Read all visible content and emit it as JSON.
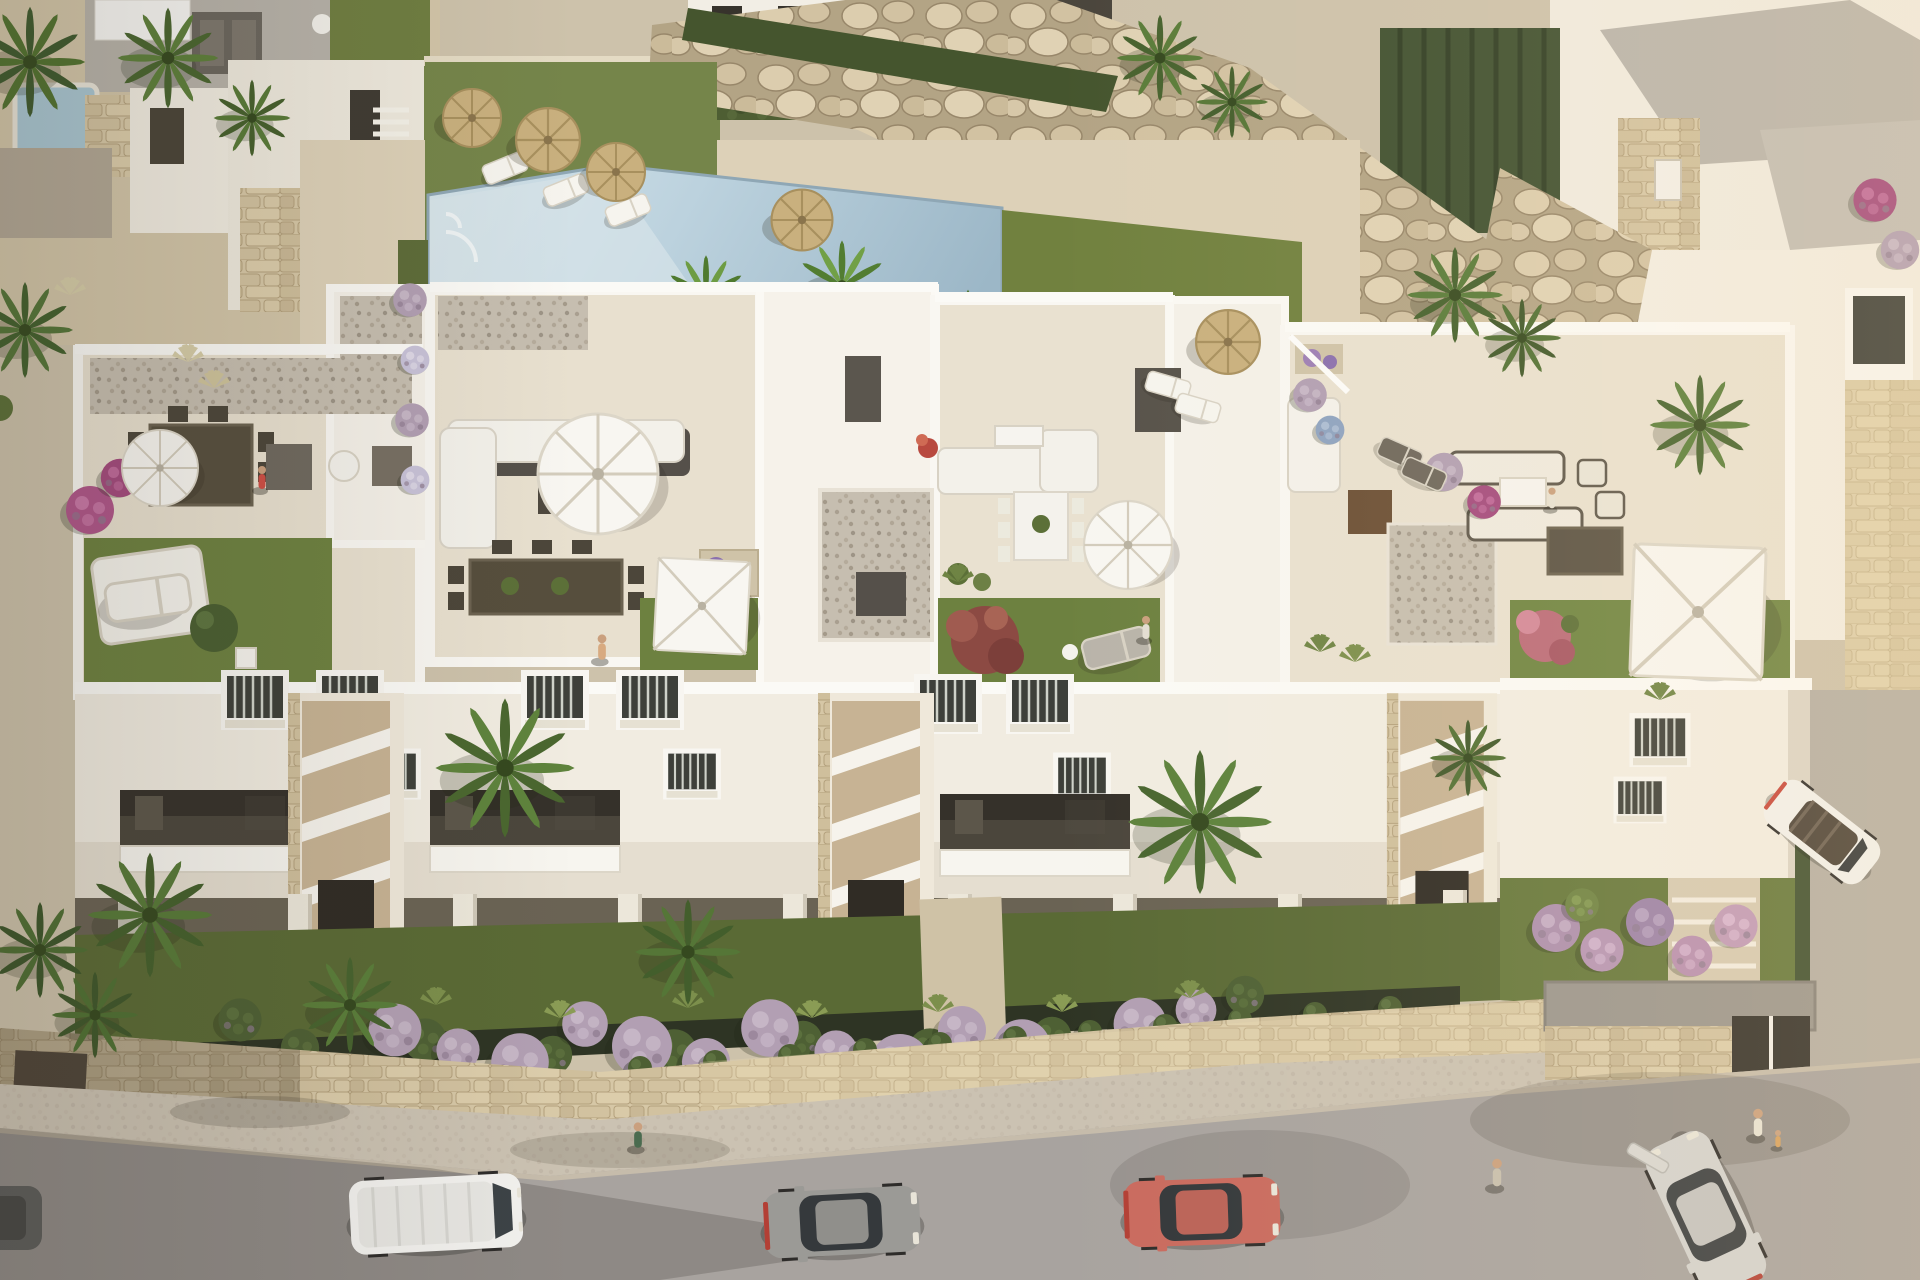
{
  "meta": {
    "type": "aerial-3d-architectural-render",
    "description": "Aerial render of a white Mediterranean apartment complex with rooftop terraces, communal pool, rock retaining wall, gardens, and a street with parked cars",
    "width": 1920,
    "height": 1280
  },
  "palette": {
    "sand": "#d2c5a8",
    "deck": "#ddd1b8",
    "wall_white": "#f2ede2",
    "parapet": "#fbfaf6",
    "roof_floor": "#e8e0cf",
    "roof_lawn": "#6d8140",
    "garden_green": "#5a6a35",
    "hedge": "#4e5e33",
    "pool_light": "#cfe1e9",
    "pool_deep": "#9cb7c7",
    "rocks": "#cfc0a2",
    "stone_wall": "#d6c7a6",
    "gravel": "#c4bcae",
    "sidewalk": "#cdc3b3",
    "asphalt": "#a8a39f",
    "purple_bush": "#b29fb3",
    "maroon_tree": "#8c4a43",
    "pink_bush": "#bb6b79",
    "straw": "#c9b07e"
  },
  "scene": {
    "palms": [
      {
        "x": 30,
        "y": 62,
        "s": 1.15,
        "a": "#3f5a2e",
        "b": "#51722f",
        "name": "palm-tree"
      },
      {
        "x": 168,
        "y": 58,
        "s": 1.05,
        "a": "#49652f",
        "b": "#5d7f3a",
        "name": "palm-tree"
      },
      {
        "x": 252,
        "y": 118,
        "s": 0.8,
        "a": "#46602c",
        "b": "#587a37",
        "name": "palm-tree"
      },
      {
        "x": 25,
        "y": 330,
        "s": 1.0,
        "a": "#42602d",
        "b": "#547538",
        "name": "palm-tree"
      },
      {
        "x": 1160,
        "y": 58,
        "s": 0.9,
        "a": "#47622e",
        "b": "#5a7c39",
        "name": "palm-tree"
      },
      {
        "x": 1232,
        "y": 102,
        "s": 0.75,
        "a": "#445e2c",
        "b": "#567637",
        "name": "palm-tree"
      },
      {
        "x": 1455,
        "y": 295,
        "s": 1.0,
        "a": "#45612d",
        "b": "#587b39",
        "name": "palm-tree"
      },
      {
        "x": 1522,
        "y": 338,
        "s": 0.82,
        "a": "#40582a",
        "b": "#517034",
        "name": "palm-tree"
      },
      {
        "x": 1700,
        "y": 425,
        "s": 1.05,
        "a": "#47642f",
        "b": "#5b7f3b",
        "name": "palm-tree"
      },
      {
        "x": 150,
        "y": 915,
        "s": 1.3,
        "a": "#44602c",
        "b": "#577a38",
        "name": "palm-tree"
      },
      {
        "x": 95,
        "y": 1015,
        "s": 0.9,
        "a": "#3e572a",
        "b": "#4f7033",
        "name": "palm-tree"
      },
      {
        "x": 350,
        "y": 1005,
        "s": 1.0,
        "a": "#47632e",
        "b": "#5a7e3a",
        "name": "palm-tree"
      },
      {
        "x": 505,
        "y": 768,
        "s": 1.45,
        "a": "#4a672f",
        "b": "#5e833c",
        "name": "palm-tree"
      },
      {
        "x": 688,
        "y": 952,
        "s": 1.1,
        "a": "#435e2c",
        "b": "#557637",
        "name": "palm-tree"
      },
      {
        "x": 1200,
        "y": 822,
        "s": 1.5,
        "a": "#49662f",
        "b": "#5d823c",
        "name": "palm-tree"
      },
      {
        "x": 1468,
        "y": 758,
        "s": 0.8,
        "a": "#41592b",
        "b": "#527134",
        "name": "palm-tree"
      },
      {
        "x": 40,
        "y": 950,
        "s": 1.0,
        "a": "#3d562a",
        "b": "#4e6e33",
        "name": "palm-tree"
      }
    ],
    "banana_palms": [
      {
        "x": 706,
        "y": 296,
        "s": 0.85,
        "a": "#4f7a2f",
        "b": "#6d9c43",
        "name": "banana-palm"
      },
      {
        "x": 842,
        "y": 286,
        "s": 0.95,
        "a": "#527d31",
        "b": "#71a046",
        "name": "banana-palm"
      },
      {
        "x": 968,
        "y": 328,
        "s": 0.8,
        "a": "#4d772e",
        "b": "#699841",
        "name": "banana-palm"
      }
    ],
    "straw_umbrellas": [
      {
        "x": 472,
        "y": 118,
        "s": 1.0,
        "name": "straw-umbrella"
      },
      {
        "x": 548,
        "y": 140,
        "s": 1.1,
        "name": "straw-umbrella"
      },
      {
        "x": 616,
        "y": 172,
        "s": 1.0,
        "name": "straw-umbrella"
      },
      {
        "x": 802,
        "y": 220,
        "s": 1.05,
        "name": "straw-umbrella"
      },
      {
        "x": 1228,
        "y": 342,
        "s": 1.1,
        "name": "straw-umbrella"
      }
    ],
    "round_umbrellas": [
      {
        "x": 160,
        "y": 468,
        "s": 0.95,
        "name": "white-parasol"
      },
      {
        "x": 598,
        "y": 474,
        "s": 1.5,
        "name": "white-parasol"
      },
      {
        "x": 1128,
        "y": 545,
        "s": 1.1,
        "name": "white-parasol"
      }
    ],
    "square_umbrellas": [
      {
        "x": 702,
        "y": 606,
        "s": 1.05,
        "r": 3,
        "name": "square-parasol"
      },
      {
        "x": 1698,
        "y": 612,
        "s": 1.5,
        "r": 2,
        "name": "square-parasol"
      }
    ],
    "loungers": [
      {
        "x": 505,
        "y": 168,
        "r": -22,
        "s": 1.0,
        "name": "sun-lounger"
      },
      {
        "x": 566,
        "y": 190,
        "r": -22,
        "s": 1.0,
        "name": "sun-lounger"
      },
      {
        "x": 628,
        "y": 210,
        "r": -22,
        "s": 1.0,
        "name": "sun-lounger"
      },
      {
        "x": 1168,
        "y": 386,
        "r": 16,
        "s": 1.0,
        "name": "sun-lounger"
      },
      {
        "x": 1198,
        "y": 408,
        "r": 16,
        "s": 1.0,
        "name": "sun-lounger"
      },
      {
        "x": 148,
        "y": 598,
        "r": -8,
        "s": 1.9,
        "name": "roof-lounger"
      },
      {
        "x": 1400,
        "y": 454,
        "r": 24,
        "s": 1.0,
        "a": "#6e675c",
        "name": "roof-lounger"
      },
      {
        "x": 1424,
        "y": 474,
        "r": 24,
        "s": 1.0,
        "a": "#6e675c",
        "name": "roof-lounger"
      },
      {
        "x": 1116,
        "y": 648,
        "r": -14,
        "s": 1.5,
        "a": "#b9b4aa",
        "name": "roof-lounger"
      }
    ],
    "purple_bushes": [
      {
        "x": 395,
        "y": 1030,
        "s": 1.1
      },
      {
        "x": 458,
        "y": 1050,
        "s": 0.9
      },
      {
        "x": 520,
        "y": 1062,
        "s": 1.2
      },
      {
        "x": 585,
        "y": 1024,
        "s": 0.95
      },
      {
        "x": 642,
        "y": 1046,
        "s": 1.25
      },
      {
        "x": 706,
        "y": 1062,
        "s": 1.0
      },
      {
        "x": 770,
        "y": 1028,
        "s": 1.2
      },
      {
        "x": 836,
        "y": 1052,
        "s": 0.9
      },
      {
        "x": 900,
        "y": 1064,
        "s": 1.25
      },
      {
        "x": 962,
        "y": 1030,
        "s": 1.0
      },
      {
        "x": 1022,
        "y": 1048,
        "s": 1.2
      },
      {
        "x": 1082,
        "y": 1058,
        "s": 0.9
      },
      {
        "x": 1140,
        "y": 1024,
        "s": 1.1
      },
      {
        "x": 1196,
        "y": 1010,
        "s": 0.85
      },
      {
        "x": 90,
        "y": 510,
        "s": 1.0,
        "a": "#b0568a",
        "b": "#cf7fae"
      },
      {
        "x": 120,
        "y": 478,
        "s": 0.8,
        "a": "#a44a7e",
        "b": "#c770a2"
      },
      {
        "x": 410,
        "y": 300,
        "s": 0.7
      },
      {
        "x": 415,
        "y": 360,
        "s": 0.6,
        "a": "#c8c2d8",
        "b": "#e2ddea"
      },
      {
        "x": 412,
        "y": 420,
        "s": 0.7
      },
      {
        "x": 415,
        "y": 480,
        "s": 0.6,
        "a": "#c8c2d8",
        "b": "#e2ddea"
      },
      {
        "x": 1310,
        "y": 395,
        "s": 0.7
      },
      {
        "x": 1330,
        "y": 430,
        "s": 0.6,
        "a": "#8ea3c0",
        "b": "#b3c3d8"
      },
      {
        "x": 1444,
        "y": 472,
        "s": 0.8
      },
      {
        "x": 1484,
        "y": 502,
        "s": 0.7,
        "a": "#a44a7e",
        "b": "#c770a2"
      },
      {
        "x": 1875,
        "y": 200,
        "s": 0.9,
        "a": "#a44a7e",
        "b": "#c770a2"
      },
      {
        "x": 1900,
        "y": 250,
        "s": 0.8
      }
    ],
    "green_bushes": [
      {
        "x": 425,
        "y": 1040,
        "s": 0.9
      },
      {
        "x": 553,
        "y": 1055,
        "s": 0.8
      },
      {
        "x": 674,
        "y": 1052,
        "s": 0.95
      },
      {
        "x": 803,
        "y": 1040,
        "s": 0.8
      },
      {
        "x": 930,
        "y": 1050,
        "s": 0.9
      },
      {
        "x": 1052,
        "y": 1036,
        "s": 0.8
      },
      {
        "x": 1168,
        "y": 1040,
        "s": 0.85
      },
      {
        "x": 240,
        "y": 1020,
        "s": 0.9
      },
      {
        "x": 300,
        "y": 1048,
        "s": 0.8
      },
      {
        "x": 1245,
        "y": 995,
        "s": 0.8
      }
    ],
    "flower_bushes_right": [
      {
        "x": 1556,
        "y": 928,
        "s": 1.0,
        "a": "#ad8fae",
        "b": "#cbb3cb"
      },
      {
        "x": 1602,
        "y": 950,
        "s": 0.9,
        "a": "#b795b5",
        "b": "#d4b8d2"
      },
      {
        "x": 1650,
        "y": 922,
        "s": 1.0,
        "a": "#9c82a8",
        "b": "#bda7c6"
      },
      {
        "x": 1692,
        "y": 956,
        "s": 0.85,
        "a": "#b98fb0",
        "b": "#d6b2cf"
      },
      {
        "x": 1736,
        "y": 926,
        "s": 0.9,
        "a": "#c19ab8",
        "b": "#ddbad4"
      },
      {
        "x": 1582,
        "y": 905,
        "s": 0.7,
        "a": "#6f8444",
        "b": "#89a058"
      }
    ],
    "hedge_balls": [
      {
        "x": 640,
        "y": 1068
      },
      {
        "x": 715,
        "y": 1062
      },
      {
        "x": 790,
        "y": 1056
      },
      {
        "x": 865,
        "y": 1050
      },
      {
        "x": 940,
        "y": 1044
      },
      {
        "x": 1015,
        "y": 1038
      },
      {
        "x": 1090,
        "y": 1032
      },
      {
        "x": 1165,
        "y": 1026
      },
      {
        "x": 1240,
        "y": 1020
      },
      {
        "x": 1315,
        "y": 1014
      },
      {
        "x": 1390,
        "y": 1008
      }
    ],
    "grass_tufts": [
      {
        "x": 188,
        "y": 362,
        "a": "#d6cda8"
      },
      {
        "x": 214,
        "y": 388,
        "a": "#cfc49c"
      },
      {
        "x": 70,
        "y": 295,
        "a": "#d6cda8"
      },
      {
        "x": 436,
        "y": 1005,
        "a": "#7c8f4c"
      },
      {
        "x": 560,
        "y": 1018,
        "a": "#8a9c55"
      },
      {
        "x": 688,
        "y": 1008,
        "a": "#7c8f4c"
      },
      {
        "x": 812,
        "y": 1018,
        "a": "#8a9c55"
      },
      {
        "x": 938,
        "y": 1012,
        "a": "#7c8f4c"
      },
      {
        "x": 1062,
        "y": 1012,
        "a": "#8a9c55"
      },
      {
        "x": 1190,
        "y": 998,
        "a": "#7c8f4c"
      },
      {
        "x": 958,
        "y": 582,
        "a": "#6f8444"
      },
      {
        "x": 1320,
        "y": 652,
        "a": "#6f8444"
      },
      {
        "x": 1355,
        "y": 662,
        "a": "#7c8f4c"
      },
      {
        "x": 1660,
        "y": 700,
        "a": "#6f8444"
      }
    ],
    "people": [
      {
        "x": 262,
        "y": 482,
        "s": 1.0,
        "a": "#cf4f45",
        "name": "person-terrace-1"
      },
      {
        "x": 602,
        "y": 652,
        "s": 1.1,
        "a": "#d8aa80",
        "name": "person-terrace-2"
      },
      {
        "x": 1146,
        "y": 632,
        "s": 1.0,
        "a": "#e3ded2",
        "name": "person-terrace-3"
      },
      {
        "x": 1552,
        "y": 502,
        "s": 0.9,
        "a": "#e8e2d4",
        "name": "person-terrace-4-seated"
      },
      {
        "x": 638,
        "y": 1140,
        "s": 1.1,
        "a": "#4a6b4f",
        "name": "pedestrian"
      },
      {
        "x": 1497,
        "y": 1178,
        "s": 1.2,
        "a": "#c7bfae",
        "name": "pedestrian"
      },
      {
        "x": 1758,
        "y": 1128,
        "s": 1.2,
        "a": "#e8e2d4",
        "name": "pedestrian-woman"
      },
      {
        "x": 1778,
        "y": 1142,
        "s": 0.75,
        "a": "#d8a25f",
        "name": "pedestrian-child"
      }
    ],
    "cars": [
      {
        "sym": "sym-van",
        "x": 436,
        "y": 1214,
        "r": -3,
        "s": 1.0,
        "a": "#f2f1ee",
        "g": "#3c4246",
        "name": "white-van"
      },
      {
        "sym": "sym-car",
        "x": 842,
        "y": 1222,
        "r": -3,
        "s": 1.0,
        "a": "#9b9a96",
        "g": "#35393c",
        "name": "gray-hatchback"
      },
      {
        "sym": "sym-car",
        "x": 1202,
        "y": 1212,
        "r": -2,
        "s": 1.0,
        "a": "#c96a5e",
        "g": "#33373a",
        "name": "red-hatchback"
      },
      {
        "sym": "sym-car",
        "x": 1706,
        "y": 1214,
        "r": -115,
        "s": 1.05,
        "a": "#d3d2cf",
        "g": "#3a3e41",
        "name": "silver-car-door-open",
        "door": {
          "x": 1648,
          "y": 1158,
          "r": -60
        }
      },
      {
        "sym": "sym-convertible",
        "x": 1822,
        "y": 832,
        "r": 38,
        "s": 0.85,
        "a": "#f2f1ed",
        "g": "#4b4238",
        "name": "white-convertible"
      }
    ],
    "windows": [
      {
        "x": 255,
        "y": 700
      },
      {
        "x": 350,
        "y": 700
      },
      {
        "x": 555,
        "y": 700
      },
      {
        "x": 650,
        "y": 700
      },
      {
        "x": 948,
        "y": 704
      },
      {
        "x": 1040,
        "y": 704
      },
      {
        "x": 392,
        "y": 774,
        "s": 0.85
      },
      {
        "x": 692,
        "y": 774,
        "s": 0.85
      },
      {
        "x": 1082,
        "y": 778,
        "s": 0.85
      },
      {
        "x": 1660,
        "y": 740,
        "s": 0.9
      },
      {
        "x": 1640,
        "y": 800,
        "s": 0.78
      }
    ],
    "balconies": [
      {
        "x": 215,
        "y": 830
      },
      {
        "x": 525,
        "y": 830
      },
      {
        "x": 1035,
        "y": 834
      }
    ],
    "stair_towers": [
      {
        "x": 346,
        "y": 818
      },
      {
        "x": 876,
        "y": 818
      },
      {
        "x": 1442,
        "y": 812,
        "s": 0.95
      }
    ],
    "pillars": [
      {
        "x": 130,
        "y": 918
      },
      {
        "x": 300,
        "y": 918
      },
      {
        "x": 465,
        "y": 918
      },
      {
        "x": 630,
        "y": 918
      },
      {
        "x": 795,
        "y": 918
      },
      {
        "x": 960,
        "y": 918
      },
      {
        "x": 1125,
        "y": 918
      },
      {
        "x": 1290,
        "y": 918
      },
      {
        "x": 1455,
        "y": 914
      }
    ]
  }
}
